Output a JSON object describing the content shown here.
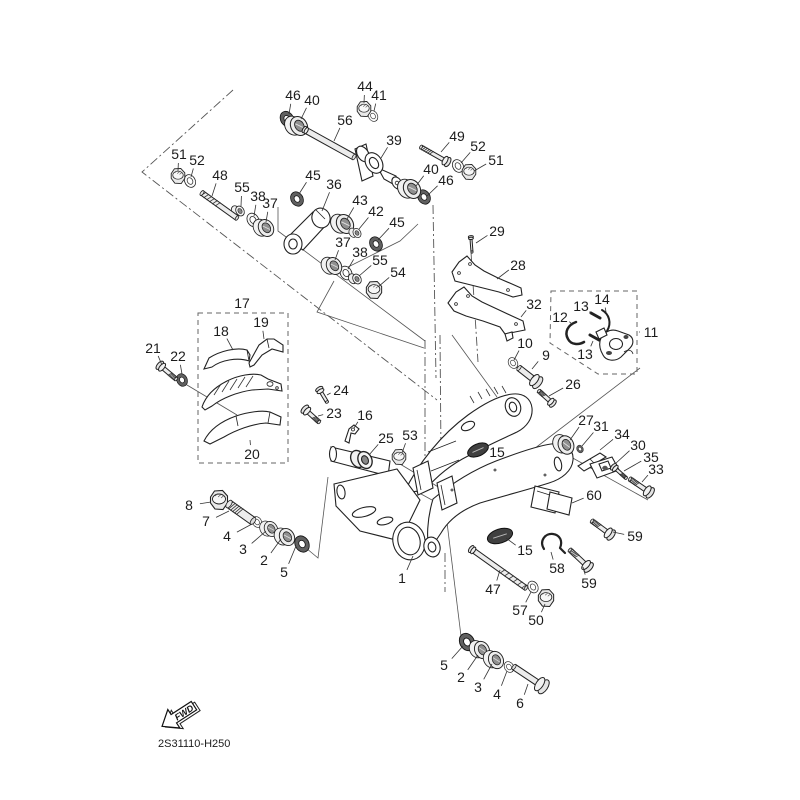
{
  "diagram": {
    "code": "2S31110-H250",
    "fwd": "FWD",
    "colors": {
      "ink": "#1c1c1c",
      "line": "#555555",
      "leader": "#333333",
      "metal": "#ececec",
      "dark": "#606060"
    }
  },
  "labels_format": [
    "text",
    "label_x",
    "label_y",
    "target_x",
    "target_y"
  ],
  "labels": [
    [
      "46",
      293,
      95,
      289,
      114
    ],
    [
      "40",
      312,
      100,
      301,
      119
    ],
    [
      "44",
      365,
      86,
      364,
      103
    ],
    [
      "41",
      379,
      95,
      374,
      111
    ],
    [
      "56",
      345,
      120,
      334,
      141
    ],
    [
      "39",
      394,
      140,
      381,
      158
    ],
    [
      "49",
      457,
      136,
      441,
      152
    ],
    [
      "52",
      478,
      146,
      461,
      163
    ],
    [
      "51",
      496,
      160,
      474,
      171
    ],
    [
      "40",
      431,
      169,
      416,
      186
    ],
    [
      "46",
      446,
      180,
      427,
      196
    ],
    [
      "51",
      179,
      154,
      178,
      171
    ],
    [
      "52",
      197,
      160,
      191,
      177
    ],
    [
      "48",
      220,
      175,
      212,
      196
    ],
    [
      "55",
      242,
      187,
      241,
      206
    ],
    [
      "38",
      258,
      196,
      254,
      216
    ],
    [
      "37",
      270,
      203,
      266,
      222
    ],
    [
      "45",
      313,
      175,
      299,
      194
    ],
    [
      "36",
      334,
      184,
      322,
      211
    ],
    [
      "43",
      360,
      200,
      347,
      219
    ],
    [
      "42",
      376,
      211,
      359,
      229
    ],
    [
      "45",
      397,
      222,
      378,
      240
    ],
    [
      "37",
      343,
      242,
      335,
      260
    ],
    [
      "38",
      360,
      252,
      348,
      269
    ],
    [
      "55",
      380,
      260,
      359,
      276
    ],
    [
      "54",
      398,
      272,
      378,
      287
    ],
    [
      "29",
      497,
      231,
      476,
      243
    ],
    [
      "28",
      518,
      265,
      497,
      279
    ],
    [
      "32",
      534,
      304,
      521,
      317
    ],
    [
      "12",
      560,
      317,
      573,
      325
    ],
    [
      "13",
      581,
      306,
      591,
      314
    ],
    [
      "14",
      602,
      299,
      606,
      312
    ],
    [
      "11",
      651,
      332,
      639,
      332
    ],
    [
      "13",
      585,
      354,
      593,
      341
    ],
    [
      "10",
      525,
      343,
      514,
      360
    ],
    [
      "9",
      546,
      355,
      532,
      369
    ],
    [
      "26",
      573,
      384,
      549,
      396
    ],
    [
      "17",
      242,
      303,
      242,
      312
    ],
    [
      "18",
      221,
      331,
      233,
      350
    ],
    [
      "19",
      261,
      322,
      264,
      339
    ],
    [
      "21",
      153,
      348,
      162,
      365
    ],
    [
      "22",
      178,
      356,
      182,
      374
    ],
    [
      "24",
      341,
      390,
      327,
      395
    ],
    [
      "23",
      334,
      413,
      318,
      416
    ],
    [
      "16",
      365,
      415,
      354,
      428
    ],
    [
      "20",
      252,
      454,
      250,
      440
    ],
    [
      "25",
      386,
      438,
      369,
      455
    ],
    [
      "53",
      410,
      435,
      402,
      453
    ],
    [
      "27",
      586,
      420,
      570,
      440
    ],
    [
      "31",
      601,
      426,
      582,
      446
    ],
    [
      "34",
      622,
      434,
      600,
      450
    ],
    [
      "30",
      638,
      445,
      615,
      464
    ],
    [
      "35",
      651,
      457,
      624,
      471
    ],
    [
      "33",
      656,
      469,
      642,
      482
    ],
    [
      "15",
      497,
      452,
      484,
      451
    ],
    [
      "15",
      525,
      550,
      506,
      538
    ],
    [
      "60",
      594,
      495,
      572,
      503
    ],
    [
      "59",
      635,
      536,
      613,
      532
    ],
    [
      "58",
      557,
      568,
      551,
      552
    ],
    [
      "59",
      589,
      583,
      583,
      567
    ],
    [
      "47",
      493,
      589,
      500,
      570
    ],
    [
      "57",
      520,
      610,
      531,
      592
    ],
    [
      "50",
      536,
      620,
      545,
      604
    ],
    [
      "5",
      444,
      665,
      463,
      646
    ],
    [
      "2",
      461,
      677,
      478,
      655
    ],
    [
      "3",
      478,
      687,
      492,
      664
    ],
    [
      "4",
      497,
      694,
      507,
      671
    ],
    [
      "6",
      520,
      703,
      528,
      684
    ],
    [
      "8",
      189,
      505,
      211,
      502
    ],
    [
      "7",
      206,
      521,
      229,
      511
    ],
    [
      "4",
      227,
      536,
      252,
      524
    ],
    [
      "3",
      243,
      549,
      266,
      531
    ],
    [
      "2",
      264,
      560,
      281,
      539
    ],
    [
      "5",
      284,
      572,
      296,
      546
    ],
    [
      "1",
      402,
      578,
      413,
      556
    ]
  ],
  "parts": [
    {
      "k": "ring",
      "x": 373,
      "y": 116,
      "s": 0.6,
      "r": -30
    },
    {
      "k": "ring",
      "x": 190,
      "y": 181,
      "s": 0.7,
      "r": -30
    },
    {
      "k": "ring",
      "x": 458,
      "y": 166,
      "s": 0.7,
      "r": -30
    },
    {
      "k": "ring",
      "x": 253,
      "y": 220,
      "s": 0.75,
      "r": -30
    },
    {
      "k": "ring",
      "x": 346,
      "y": 273,
      "s": 0.75,
      "r": -30
    },
    {
      "k": "ring",
      "x": 513,
      "y": 363,
      "s": 0.6,
      "r": -30
    },
    {
      "k": "ring",
      "x": 533,
      "y": 587,
      "s": 0.65,
      "r": -30
    },
    {
      "k": "ring",
      "x": 257,
      "y": 522,
      "s": 0.6,
      "r": -30
    },
    {
      "k": "ring",
      "x": 509,
      "y": 667,
      "s": 0.6,
      "r": -30
    },
    {
      "k": "seal",
      "x": 287,
      "y": 119,
      "s": 0.8,
      "r": -30
    },
    {
      "k": "seal",
      "x": 424,
      "y": 197,
      "s": 0.75,
      "r": -30
    },
    {
      "k": "seal",
      "x": 297,
      "y": 199,
      "s": 0.75,
      "r": -30
    },
    {
      "k": "seal",
      "x": 376,
      "y": 244,
      "s": 0.75,
      "r": -30
    },
    {
      "k": "seal",
      "x": 302,
      "y": 544,
      "s": 0.85,
      "r": -30
    },
    {
      "k": "seal",
      "x": 467,
      "y": 642,
      "s": 0.9,
      "r": -28
    },
    {
      "k": "seal",
      "x": 182,
      "y": 380,
      "s": 0.65,
      "r": -25
    },
    {
      "k": "seal",
      "x": 580,
      "y": 449,
      "s": 0.4,
      "r": -25
    },
    {
      "k": "bearing",
      "x": 299,
      "y": 126,
      "s": 0.95,
      "r": -32
    },
    {
      "k": "bearing",
      "x": 412,
      "y": 189,
      "s": 0.95,
      "r": -32
    },
    {
      "k": "bearing",
      "x": 266,
      "y": 228,
      "s": 0.85,
      "r": -32
    },
    {
      "k": "bearing",
      "x": 334,
      "y": 266,
      "s": 0.85,
      "r": -32
    },
    {
      "k": "bearing",
      "x": 345,
      "y": 224,
      "s": 0.95,
      "r": -32
    },
    {
      "k": "bearing",
      "x": 566,
      "y": 445,
      "s": 0.9,
      "r": -22
    },
    {
      "k": "bearing",
      "x": 271,
      "y": 529,
      "s": 0.75,
      "r": -30
    },
    {
      "k": "bearing",
      "x": 287,
      "y": 537,
      "s": 0.85,
      "r": -30
    },
    {
      "k": "bearing",
      "x": 482,
      "y": 650,
      "s": 0.85,
      "r": -26
    },
    {
      "k": "bearing",
      "x": 496,
      "y": 660,
      "s": 0.85,
      "r": -26
    },
    {
      "k": "nut",
      "x": 364,
      "y": 109,
      "s": 0.8,
      "r": 0
    },
    {
      "k": "nut",
      "x": 178,
      "y": 176,
      "s": 0.8,
      "r": 0
    },
    {
      "k": "nut",
      "x": 469,
      "y": 172,
      "s": 0.8,
      "r": 0
    },
    {
      "k": "nut",
      "x": 219,
      "y": 500,
      "s": 1.0,
      "r": 0
    },
    {
      "k": "nut",
      "x": 546,
      "y": 598,
      "s": 0.9,
      "r": 0
    },
    {
      "k": "nut",
      "x": 399,
      "y": 457,
      "s": 0.8,
      "r": 0
    },
    {
      "k": "nut",
      "x": 374,
      "y": 290,
      "s": 0.9,
      "r": 0
    },
    {
      "k": "bush",
      "x": 240,
      "y": 211,
      "s": 0.8,
      "r": -30
    },
    {
      "k": "bush",
      "x": 357,
      "y": 279,
      "s": 0.8,
      "r": -30
    },
    {
      "k": "bush",
      "x": 357,
      "y": 233,
      "s": 0.75,
      "r": -30
    },
    {
      "k": "bush",
      "x": 365,
      "y": 460,
      "s": 1.35,
      "r": -25
    },
    {
      "k": "cap",
      "x": 478,
      "y": 450,
      "rx": 11,
      "ry": 6,
      "r": -24
    },
    {
      "k": "cap",
      "x": 500,
      "y": 536,
      "rx": 13,
      "ry": 7,
      "r": -18
    },
    {
      "k": "bolt",
      "x1": 202,
      "y1": 193,
      "x2": 237,
      "y2": 218,
      "w": 5,
      "hr": 0,
      "th": "s",
      "hs": "s"
    },
    {
      "k": "bolt",
      "x1": 421,
      "y1": 147,
      "x2": 444,
      "y2": 160,
      "w": 4,
      "hr": 5,
      "th": "s",
      "hs": "e"
    },
    {
      "k": "bolt",
      "x1": 229,
      "y1": 504,
      "x2": 253,
      "y2": 521,
      "w": 8,
      "hr": 0,
      "th": "s",
      "hs": "s"
    },
    {
      "k": "bolt",
      "x1": 474,
      "y1": 551,
      "x2": 526,
      "y2": 588,
      "w": 5,
      "hr": 4,
      "th": "e",
      "hs": "s"
    },
    {
      "k": "bolt",
      "x1": 514,
      "y1": 667,
      "x2": 538,
      "y2": 683,
      "w": 6,
      "hr": 8,
      "th": "",
      "hs": "e"
    },
    {
      "k": "bolt",
      "x1": 163,
      "y1": 368,
      "x2": 176,
      "y2": 379,
      "w": 4,
      "hr": 5,
      "th": "e",
      "hs": "s"
    },
    {
      "k": "bolt",
      "x1": 308,
      "y1": 412,
      "x2": 319,
      "y2": 422,
      "w": 4,
      "hr": 5,
      "th": "e",
      "hs": "s"
    },
    {
      "k": "bolt",
      "x1": 321,
      "y1": 392,
      "x2": 327,
      "y2": 402,
      "w": 3,
      "hr": 4,
      "th": "",
      "hs": "s"
    },
    {
      "k": "bolt",
      "x1": 539,
      "y1": 391,
      "x2": 550,
      "y2": 401,
      "w": 4,
      "hr": 4.5,
      "th": "s",
      "hs": "e"
    },
    {
      "k": "bolt",
      "x1": 630,
      "y1": 479,
      "x2": 646,
      "y2": 490,
      "w": 4.5,
      "hr": 6,
      "th": "s",
      "hs": "e"
    },
    {
      "k": "bolt",
      "x1": 616,
      "y1": 469,
      "x2": 626,
      "y2": 478,
      "w": 3,
      "hr": 4,
      "th": "e",
      "hs": "s"
    },
    {
      "k": "bolt",
      "x1": 592,
      "y1": 521,
      "x2": 607,
      "y2": 532,
      "w": 4.5,
      "hr": 6,
      "th": "s",
      "hs": "e"
    },
    {
      "k": "bolt",
      "x1": 570,
      "y1": 550,
      "x2": 585,
      "y2": 564,
      "w": 4.5,
      "hr": 6,
      "th": "s",
      "hs": "e"
    },
    {
      "k": "bolt",
      "x1": 471,
      "y1": 239,
      "x2": 472,
      "y2": 252,
      "w": 2,
      "hr": 2.5,
      "th": "",
      "hs": "s"
    },
    {
      "k": "bolt",
      "x1": 519,
      "y1": 368,
      "x2": 533,
      "y2": 379,
      "w": 6,
      "hr": 7,
      "th": "",
      "hs": "e"
    },
    {
      "k": "bolt",
      "x1": 307,
      "y1": 131,
      "x2": 354,
      "y2": 157,
      "w": 6,
      "hr": 3.5,
      "th": "",
      "hs": "s"
    },
    {
      "k": "stroke",
      "d": "M576,322 C568,325 564,332 568,339 C571,345 579,345 584,342",
      "w": 2.5
    },
    {
      "k": "stroke",
      "d": "M591,313 L600,318",
      "w": 3
    },
    {
      "k": "stroke",
      "d": "M590,335 L599,340",
      "w": 3
    },
    {
      "k": "stroke",
      "d": "M602,310 C609,314 612,323 607,331",
      "w": 2
    },
    {
      "k": "stroke",
      "d": "M544,549 C539,541 545,533 553,534 C560,535 563,541 560,548 M560,548 L565,553",
      "w": 2.2
    }
  ],
  "construction": {
    "dashdot": [
      [
        [
          233,
          90
        ],
        [
          142,
          172
        ],
        [
          437,
          400
        ]
      ],
      [
        [
          433,
          205
        ],
        [
          436,
          378
        ]
      ],
      [
        [
          425,
          340
        ],
        [
          425,
          478
        ]
      ],
      [
        [
          440,
          335
        ],
        [
          441,
          455
        ]
      ],
      [
        [
          445,
          553
        ],
        [
          445,
          592
        ]
      ],
      [
        [
          471,
          252
        ],
        [
          478,
          362
        ]
      ]
    ],
    "solid": [
      [
        [
          278,
          207
        ],
        [
          278,
          231
        ],
        [
          425,
          341
        ]
      ],
      [
        [
          418,
          224
        ],
        [
          400,
          241
        ],
        [
          340,
          271
        ]
      ],
      [
        [
          334,
          281
        ],
        [
          317,
          312
        ],
        [
          424,
          348
        ]
      ],
      [
        [
          640,
          368
        ],
        [
          530,
          452
        ]
      ],
      [
        [
          562,
          452
        ],
        [
          648,
          500
        ]
      ],
      [
        [
          187,
          385
        ],
        [
          237,
          415
        ]
      ],
      [
        [
          328,
          477
        ],
        [
          318,
          558
        ],
        [
          306,
          548
        ]
      ],
      [
        [
          443,
          490
        ],
        [
          461,
          636
        ]
      ],
      [
        [
          370,
          466
        ],
        [
          432,
          500
        ]
      ],
      [
        [
          400,
          464
        ],
        [
          440,
          488
        ]
      ],
      [
        [
          452,
          335
        ],
        [
          497,
          397
        ]
      ]
    ],
    "dashed_boxes": [
      {
        "name": "chain-guide-group-box",
        "pts": [
          [
            198,
            313
          ],
          [
            288,
            313
          ],
          [
            288,
            463
          ],
          [
            198,
            463
          ]
        ]
      },
      {
        "name": "tensioner-group-box",
        "pts": [
          [
            551,
            291
          ],
          [
            637,
            291
          ],
          [
            637,
            374
          ],
          [
            598,
            374
          ],
          [
            550,
            343
          ]
        ]
      }
    ]
  }
}
